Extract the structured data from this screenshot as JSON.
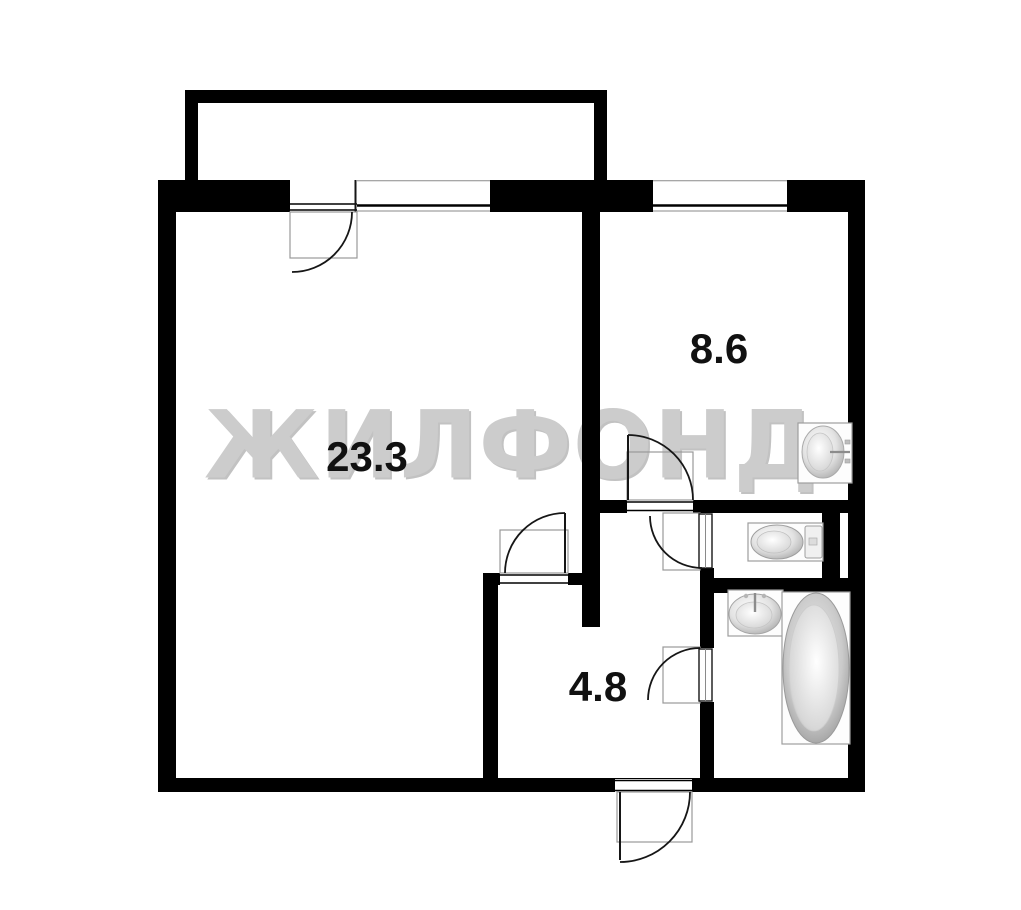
{
  "watermark": {
    "text": "ЖИЛФОНД"
  },
  "rooms": [
    {
      "id": "living-room",
      "area_label": "23.3"
    },
    {
      "id": "kitchen",
      "area_label": "8.6"
    },
    {
      "id": "hallway",
      "area_label": "4.8"
    }
  ],
  "features": {
    "unlabeled_rooms": [
      "balcony",
      "wc",
      "bathroom"
    ],
    "fixtures": [
      "kitchen-sink",
      "toilet",
      "bathroom-sink",
      "bathtub"
    ],
    "doors": [
      "balcony-door",
      "kitchen-door",
      "living-room-door",
      "wc-door",
      "bathroom-door",
      "entrance-door"
    ],
    "windows": [
      "living-room-window",
      "kitchen-window"
    ]
  },
  "colors": {
    "wall": "#000000",
    "watermark": "#cccccc",
    "label": "#111111",
    "door_frame": "#999999",
    "fixture_outline": "#9e9e9e",
    "background": "#ffffff"
  }
}
